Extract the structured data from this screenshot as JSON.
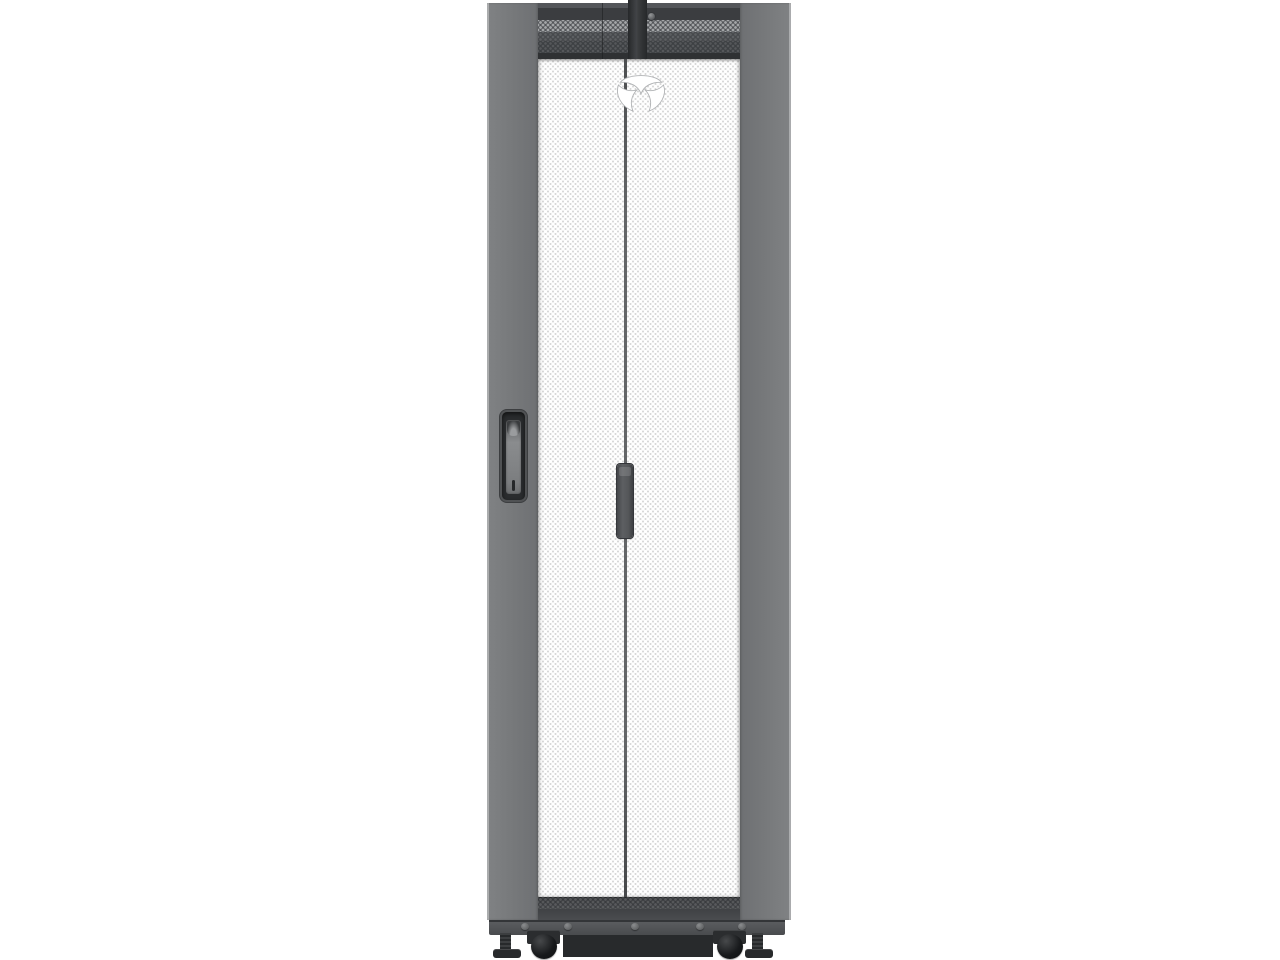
{
  "scene": {
    "description": "Product photo of a black freestanding server rack enclosure with perforated split front mesh doors, vented top header, recessed door handle, center latch handle, base bar with bolts, casters and leveling feet, shown front-on against a white background",
    "brand_mark": "vertiv-logo"
  },
  "colors": {
    "background": "#ffffff",
    "side-panel": "#76787a",
    "side-panel-light": "#808284",
    "side-panel-dark": "#6e7073",
    "header-dark": "#3b3d40",
    "header-band": "#54565a",
    "vent-dot": "#a3a5a7",
    "mesh-web": "#c8c8c8",
    "mesh-hole": "#ffffff",
    "door-split": "#636567",
    "handle-recess": "#2a2c2e",
    "handle-lever": "#8a8c8e",
    "center-handle": "#5d5f62",
    "door-bottom": "#4a4c4f",
    "base-bar": "#5a5c5f",
    "bolt": "#5f6163",
    "recess-panel": "#282a2c",
    "caster": "#17191b",
    "foot": "#27292b",
    "logo-fill": "#ffffff",
    "logo-outline": "#b0b2b4"
  }
}
